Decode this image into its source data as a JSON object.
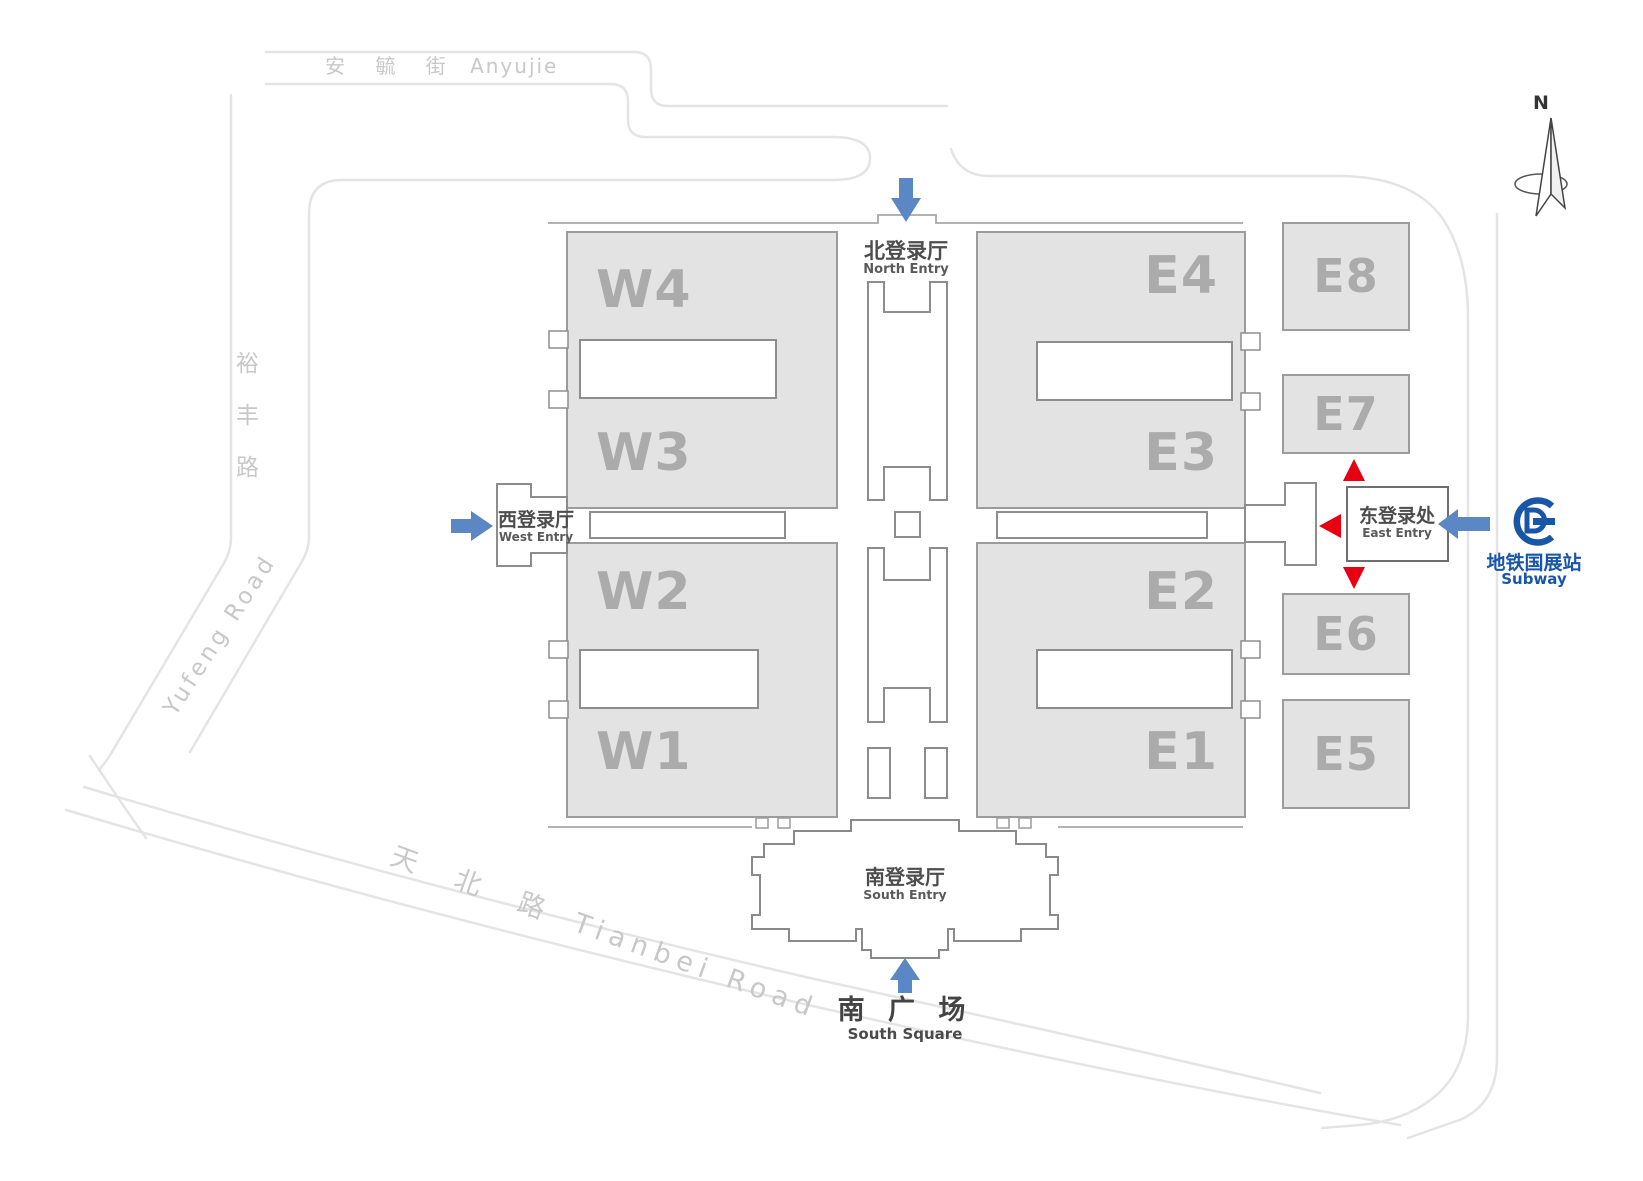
{
  "title": "Exhibition Center Site Map",
  "roads": {
    "anyujie": {
      "cjk": "安 毓 街",
      "en": "Anyujie"
    },
    "yufeng": {
      "cjk_vertical": "裕\n丰\n路",
      "en": "Yufeng Road"
    },
    "tianbei": {
      "cjk": "天 北 路",
      "en": "Tianbei Road"
    }
  },
  "entries": {
    "north": {
      "cjk": "北登录厅",
      "en": "North Entry"
    },
    "west": {
      "cjk": "西登录厅",
      "en": "West Entry"
    },
    "east": {
      "cjk": "东登录处",
      "en": "East Entry"
    },
    "south": {
      "cjk": "南登录厅",
      "en": "South Entry"
    }
  },
  "plaza": {
    "cjk": "南 广 场",
    "en": "South Square"
  },
  "subway": {
    "station": "地铁国展站",
    "label": "Subway"
  },
  "compass": {
    "n": "N"
  },
  "halls": {
    "w1": "W1",
    "w2": "W2",
    "w3": "W3",
    "w4": "W4",
    "e1": "E1",
    "e2": "E2",
    "e3": "E3",
    "e4": "E4",
    "e5": "E5",
    "e6": "E6",
    "e7": "E7",
    "e8": "E8"
  },
  "colors": {
    "arrow_blue": "#5b87c5",
    "arrow_red": "#e60012",
    "subway_blue": "#1a56a8",
    "hall_fill": "#e3e3e3",
    "hall_border": "#9c9c9c",
    "hall_label": "#ababab",
    "road_gray": "#e4e4e4",
    "outline_gray": "#8d8d8d"
  }
}
